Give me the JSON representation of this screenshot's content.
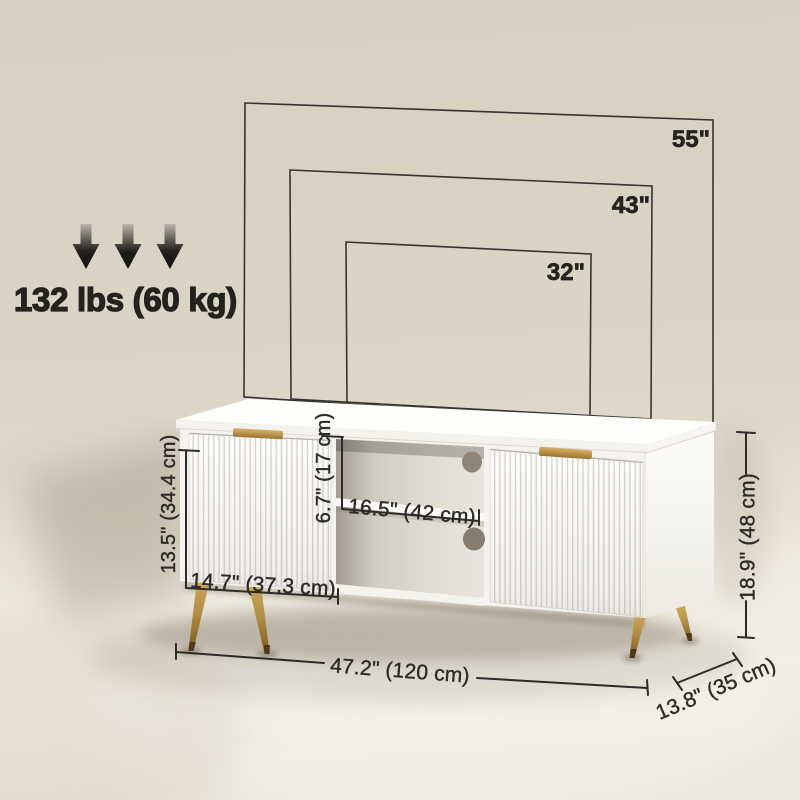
{
  "title": "TV stand dimension diagram",
  "weight_capacity": {
    "label": "132 lbs (60 kg)"
  },
  "tv_compatibility": {
    "sizes": [
      {
        "label": "55\""
      },
      {
        "label": "43\""
      },
      {
        "label": "32\""
      }
    ]
  },
  "dimensions": {
    "cabinet_height": "13.5\" (34.4 cm)",
    "cabinet_width": "14.7\" (37.3 cm)",
    "compartment_height": "6.7\" (17 cm)",
    "shelf_width": "16.5\" (42 cm)",
    "overall_height": "18.9\" (48 cm)",
    "overall_width": "47.2\" (120 cm)",
    "overall_depth": "13.8\" (35 cm)"
  },
  "colors": {
    "wall": "#d9d3c4",
    "floor": "#f1eee2",
    "annotation_ink": "#2c2b27",
    "brass_accent": "#b8914a",
    "cabinet_white": "#f8f7f3",
    "cable_hole": "#8e8476"
  }
}
